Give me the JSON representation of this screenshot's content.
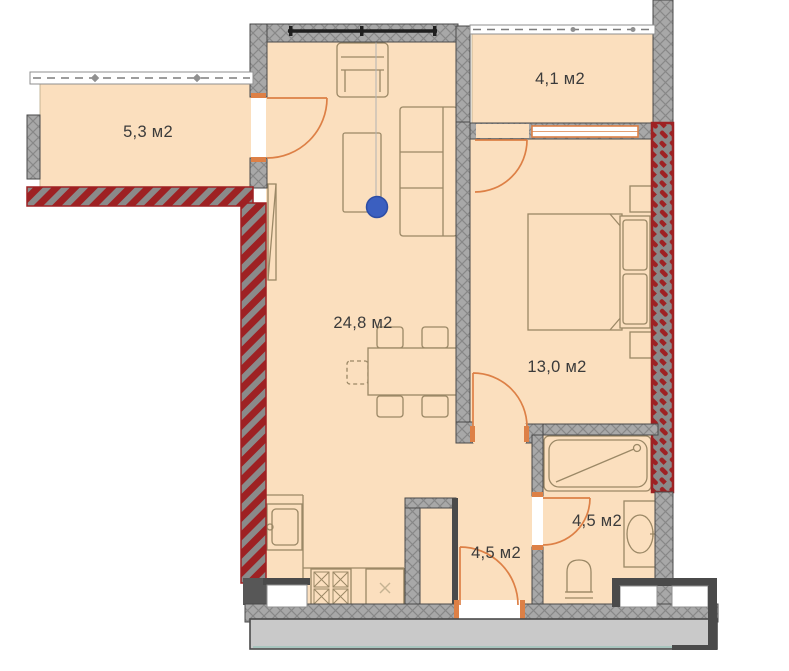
{
  "plan": {
    "type": "apartment-floor-plan",
    "units": "м2",
    "rooms": [
      {
        "id": "balcony-left",
        "label": "5,3 м2",
        "area": 5.3
      },
      {
        "id": "balcony-top",
        "label": "4,1 м2",
        "area": 4.1
      },
      {
        "id": "living-kitchen",
        "label": "24,8 м2",
        "area": 24.8
      },
      {
        "id": "bedroom",
        "label": "13,0 м2",
        "area": 13.0
      },
      {
        "id": "bathroom",
        "label": "4,5 м2",
        "area": 4.5
      },
      {
        "id": "hallway",
        "label": "4,5 м2",
        "area": 4.5
      }
    ],
    "marker": {
      "x": 377,
      "y": 207,
      "color": "#3b5fc0"
    },
    "colors": {
      "floor": "#fbdfbe",
      "wallGray": "#a8a8a8",
      "hatchLine": "#878787",
      "wallDark": "#4a4a4a",
      "wallRed": "#9e2123",
      "redBase": "#8a8a8a",
      "doorOrange": "#dd8046",
      "furnLine": "#9b8866",
      "textColor": "#3b3b3b",
      "markerBlue": "#3b5fc0",
      "slabGray": "#c9c9c9",
      "tealLine": "#9ec4ba",
      "glazeLine": "#7d7d7d"
    }
  }
}
